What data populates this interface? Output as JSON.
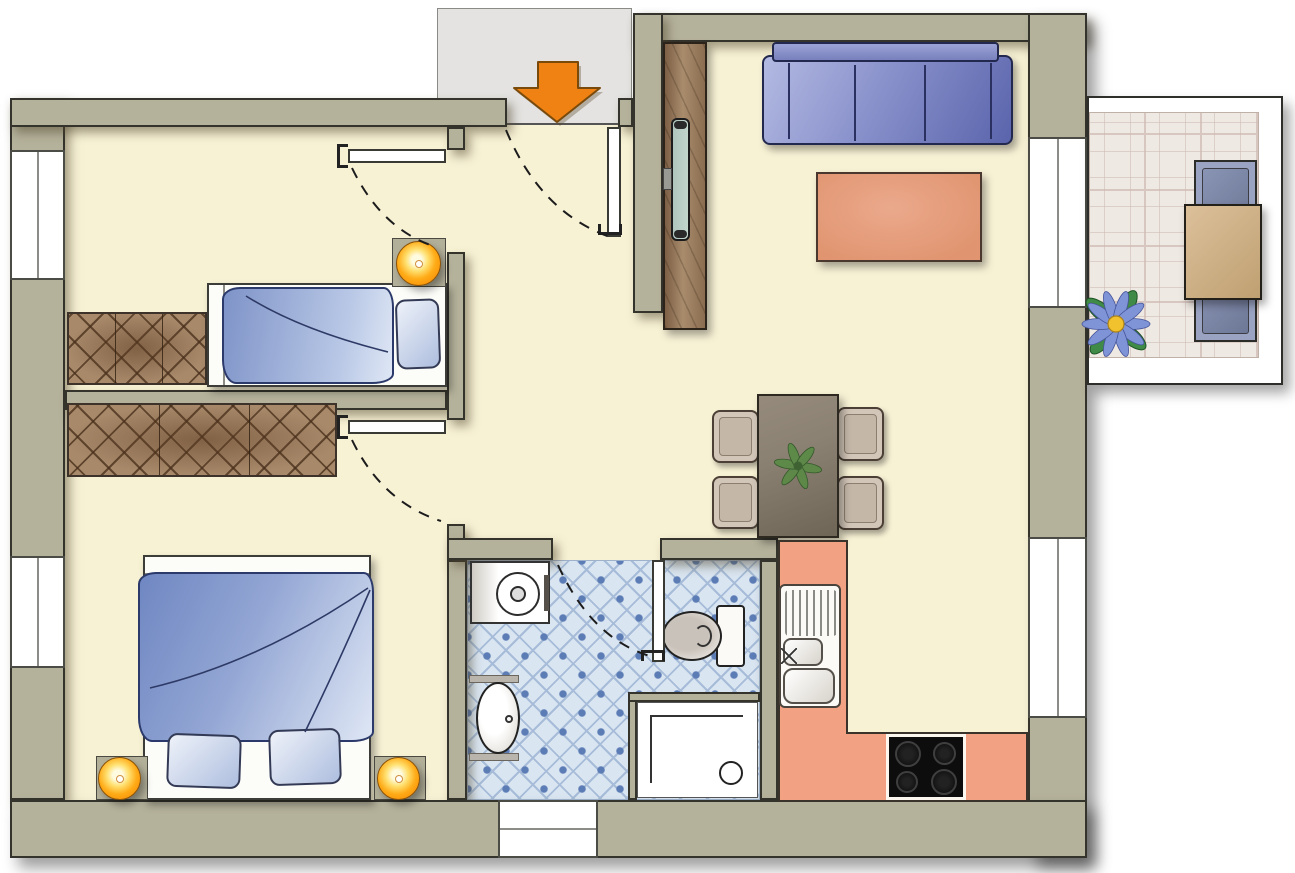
{
  "meta": {
    "kind": "apartment-floor-plan",
    "width_px": 1295,
    "height_px": 873,
    "text_visible": "none"
  },
  "colors": {
    "wall": "#b5b29b",
    "wall_edge": "#34332c",
    "floor": "#f8f2d5",
    "vestibule": "#e4e3e1",
    "outside": "#ffffff",
    "arrow": "#f08214",
    "arrow_edge": "#7a4a0a",
    "bath_tile_bg": "#d9e5f1",
    "bath_tile_line": "#a6bcd8",
    "bath_tile_dot": "#5c7cb5",
    "balcony_tile_bg": "#efe9e3",
    "balcony_tile_line": "#d8c7c0",
    "wardrobe": "#a8896a",
    "wardrobe_hatch": "#5f4226",
    "bed_frame": "#fcfcf9",
    "duvet_dark": "#6f87c2",
    "duvet_light": "#dfe7f5",
    "pillow": "#aebedf",
    "lamp_core": "#fffbe0",
    "lamp_glow": "#f07f00",
    "sofa_light": "#b3bae2",
    "sofa_dark": "#5a64ab",
    "rug": "#e0946f",
    "cabinet": "#a98c6c",
    "tv": "#c3d6cd",
    "counter": "#f2a183",
    "stove": "#0d0d0d",
    "table_dining": "#8b8173",
    "chair_dining": "#d2c6b8",
    "table_balcony": "#cfb28a",
    "chair_balcony": "#9aa4c2",
    "fixture_white": "#fbfaf7",
    "door_leaf": "#ffffff",
    "window_frame": "#4c4c46",
    "flower_petal": "#7f94d6",
    "flower_center": "#f2c12e",
    "leaf_green": "#3f8a46"
  },
  "rooms": [
    {
      "id": "entrance",
      "features": [
        "gray-vestibule-outside",
        "orange-entry-arrow-pointing-in",
        "entry-door-open-with-swing-arc"
      ]
    },
    {
      "id": "hallway",
      "doors_to": [
        "child-room",
        "master-bedroom",
        "bathroom"
      ],
      "open_to": [
        "living-dining-area"
      ]
    },
    {
      "id": "child-room",
      "windows": 1,
      "furniture": [
        "wardrobe-3-sections",
        "single-bed-blue-duvet",
        "pillow",
        "bedside-lamp-orange"
      ]
    },
    {
      "id": "master-bedroom",
      "windows": 1,
      "furniture": [
        "wardrobe-3-sections",
        "double-bed-blue-duvet",
        "pillow",
        "pillow",
        "bedside-lamp-orange",
        "bedside-lamp-orange"
      ]
    },
    {
      "id": "living-room",
      "openings": [
        "balcony-door-window"
      ],
      "furniture": [
        "tv-cabinet",
        "wall-tv",
        "sofa-3-seats-blue",
        "rug-salmon"
      ]
    },
    {
      "id": "dining-area",
      "furniture": [
        "dining-table",
        "chair",
        "chair",
        "chair",
        "chair",
        "table-plant"
      ]
    },
    {
      "id": "kitchen",
      "windows": 1,
      "furniture": [
        "l-shaped-counter-salmon",
        "double-sink-with-drainer",
        "stove-4-burners"
      ]
    },
    {
      "id": "bathroom",
      "windows": 1,
      "floor": "blue-diamond-tiles",
      "furniture": [
        "washing-machine",
        "washbasin-oval",
        "toilet",
        "shower-with-drain"
      ]
    },
    {
      "id": "balcony",
      "floor": "stone-tiles-white-railing",
      "furniture": [
        "table-tan",
        "chair-blue",
        "chair-blue",
        "flower-blue"
      ]
    }
  ],
  "doors": [
    {
      "id": "entrance-door",
      "state": "open",
      "swing": "dashed-arc"
    },
    {
      "id": "child-room-door",
      "state": "open",
      "swing": "dashed-arc"
    },
    {
      "id": "master-bedroom-door",
      "state": "open",
      "swing": "dashed-arc"
    },
    {
      "id": "bathroom-door",
      "state": "open",
      "swing": "dashed-arc"
    }
  ],
  "icons": [
    "entry-arrow-icon",
    "flower-icon",
    "plant-icon",
    "stove-burner-icon",
    "drain-icon"
  ]
}
